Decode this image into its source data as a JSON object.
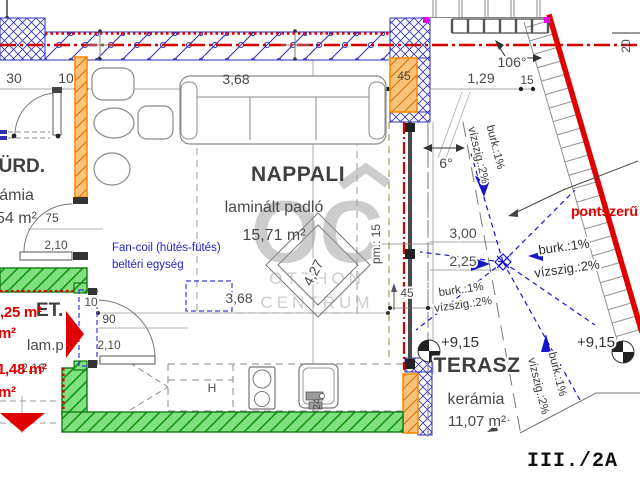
{
  "sheet_label": "III./2A",
  "watermark": {
    "initials": "OC",
    "name_top": "OTTHON",
    "name_bottom": "CENTRUM"
  },
  "rooms": {
    "nappali": {
      "name": "NAPPALI",
      "floor": "laminált padló",
      "area": "15,71 m²"
    },
    "terasz": {
      "name": "TERASZ",
      "floor": "kerámia",
      "area": "11,07 m²"
    },
    "furdo": {
      "name": "FÜRD.",
      "floor": "kerámia",
      "area": "54 m²"
    },
    "etkezo": {
      "name": "ET.",
      "floor": "lam.p"
    }
  },
  "annotations": {
    "fancoil_line1": "Fan-coil (hütés-fütés)",
    "fancoil_line2": "beltéri egység",
    "drain_type": "pontszerű",
    "slope_tile": "burk.:1%",
    "slope_waterproof": "vízszig.:2%",
    "level_left": "+9,15",
    "level_right": "+9,15",
    "fridge": "H",
    "red_area_small_1": "1,25 m²",
    "red_area_small_2": "1,48 m²",
    "red_area_fragment_1": "m²",
    "red_area_fragment_2": "m²"
  },
  "dimensions": {
    "top_left_1": "30",
    "top_left_2": "10",
    "sofa_wall": "3,68",
    "pillar": "45",
    "terrace_top_1": "1,29",
    "terrace_top_2": "15",
    "angle_top": "106°",
    "edge_right": "20",
    "angle_terrace": "6°",
    "terrace_x": "3,00",
    "terrace_y": "2,25",
    "glass_wall": "45",
    "diagonal": "4,27",
    "parapet": "pm.: 15",
    "furdo_door_w": "75",
    "furdo_door_h": "2,10",
    "et_door_gap": "10",
    "et_door_w": "90",
    "et_door_h": "2,10",
    "nappali_width": "3,68",
    "et_width": "2,16",
    "axis": "24"
  }
}
